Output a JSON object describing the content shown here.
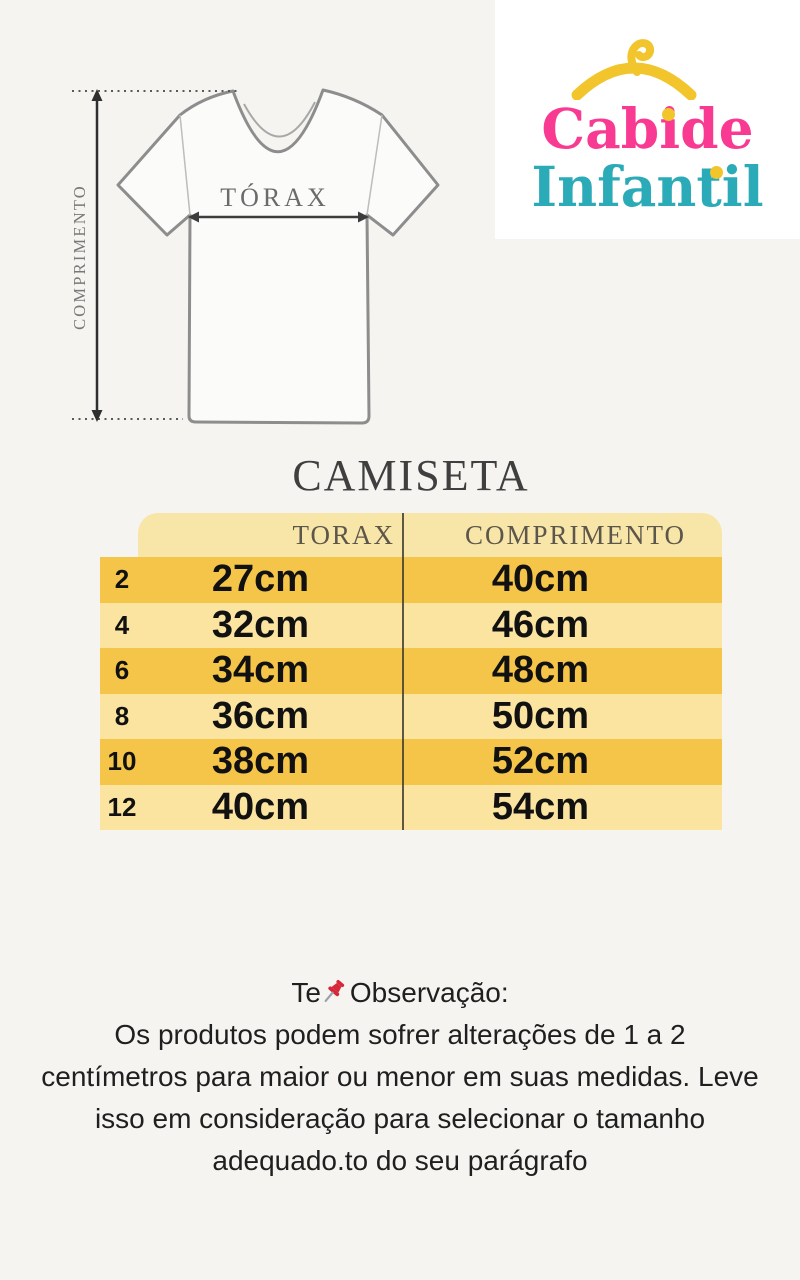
{
  "colors": {
    "page_bg": "#f5f4f1",
    "logo_bg": "#ffffff",
    "pink": "#f93a92",
    "teal": "#2babb8",
    "yellow": "#f1c52b",
    "row_dark": "#f4c549",
    "row_light": "#fae4a0",
    "header_bg": "#f8e6a9",
    "divider": "#433d31",
    "pin_red": "#d62839",
    "text_dark": "#1f1f1f"
  },
  "logo": {
    "line1": "Cabide",
    "line2": "Infantil"
  },
  "diagram": {
    "chest_label": "TÓRAX",
    "length_label": "COMPRIMENTO"
  },
  "title": "CAMISETA",
  "size_table": {
    "columns": [
      "TORAX",
      "COMPRIMENTO"
    ],
    "rows": [
      {
        "size": "2",
        "torax": "27cm",
        "comprimento": "40cm"
      },
      {
        "size": "4",
        "torax": "32cm",
        "comprimento": "46cm"
      },
      {
        "size": "6",
        "torax": "34cm",
        "comprimento": "48cm"
      },
      {
        "size": "8",
        "torax": "36cm",
        "comprimento": "50cm"
      },
      {
        "size": "10",
        "torax": "38cm",
        "comprimento": "52cm"
      },
      {
        "size": "12",
        "torax": "40cm",
        "comprimento": "54cm"
      }
    ]
  },
  "note": {
    "prefix": "Te",
    "title": "Observação:",
    "lines": [
      "Os produtos podem sofrer alterações de 1 a 2",
      "centímetros para maior ou menor em suas medidas. Leve",
      "isso em consideração para selecionar o tamanho",
      "adequado.to do seu parágrafo"
    ]
  }
}
